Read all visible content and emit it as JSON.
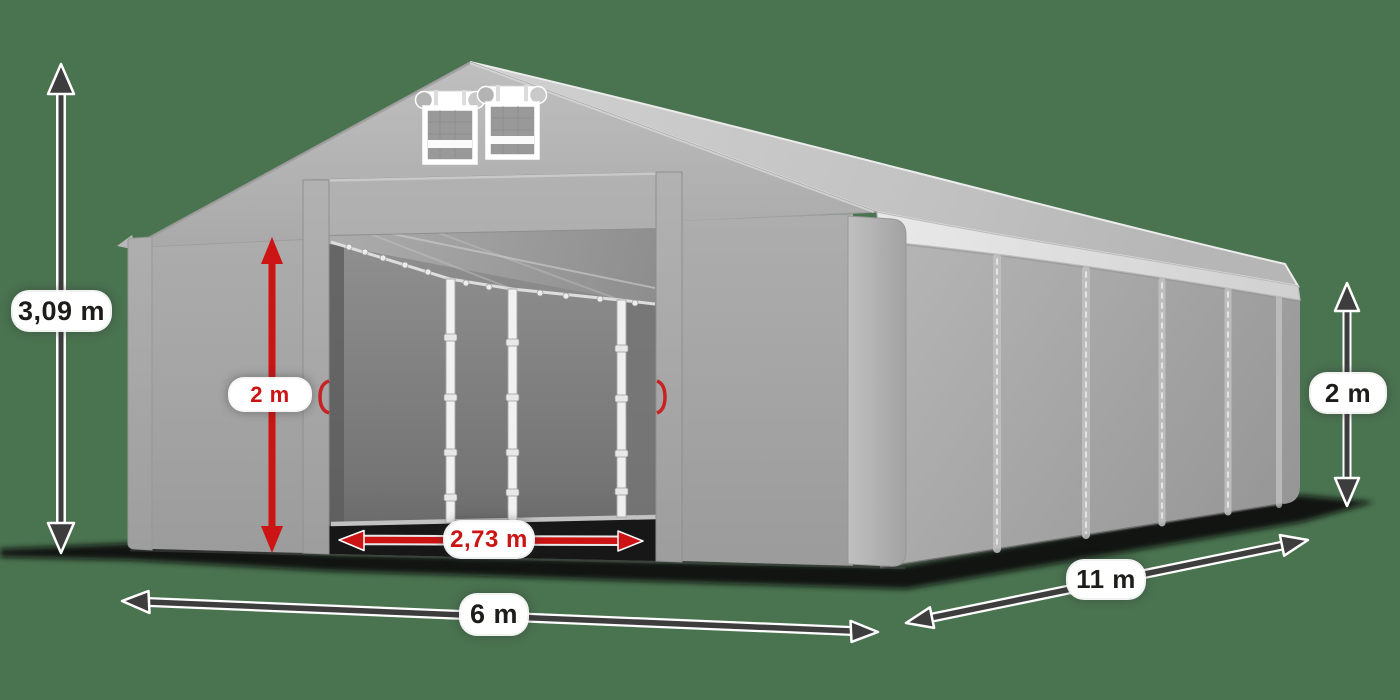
{
  "dimensions": {
    "total_height": {
      "label": "3,09 m",
      "style": "dark",
      "meaning": "ridge height"
    },
    "entrance_height": {
      "label": "2 m",
      "style": "red",
      "meaning": "entrance height"
    },
    "entrance_width": {
      "label": "2,73 m",
      "style": "red",
      "meaning": "entrance width"
    },
    "front_width": {
      "label": "6 m",
      "style": "dark",
      "meaning": "tent width"
    },
    "side_length": {
      "label": "11 m",
      "style": "dark",
      "meaning": "tent length"
    },
    "side_wall_height": {
      "label": "2 m",
      "style": "dark",
      "meaning": "side wall height"
    }
  },
  "colors": {
    "background": "#4a7350",
    "accent_red": "#cc1414",
    "arrow_dark": "#3d3d3d",
    "label_text_dark": "#1d1d1b",
    "label_bg": "#ffffff"
  }
}
